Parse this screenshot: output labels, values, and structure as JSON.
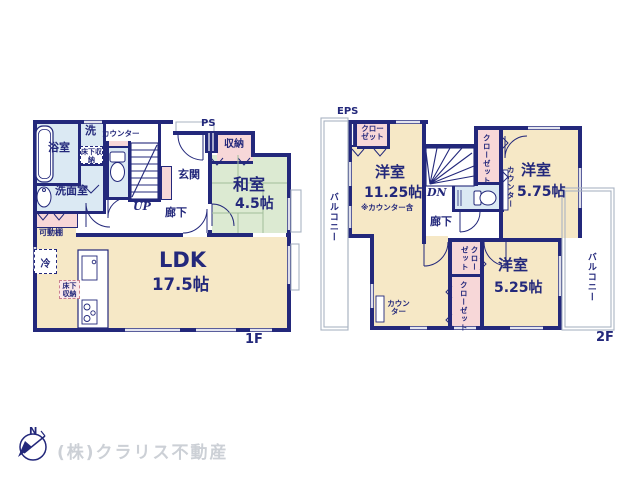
{
  "colors": {
    "wall_navy": "#23287b",
    "room_cream": "#f6e8c6",
    "tatami_green": "#dcead2",
    "wet_blue": "#dbe9f3",
    "closet_pink": "#f7d7d8",
    "outline_gray": "#a9b3c2",
    "company_gray": "#ccd0d6"
  },
  "floor1": {
    "floor_label": "1F",
    "bath": "浴室",
    "laundry": "洗",
    "underfloor_laundry": "床下収納",
    "washroom": "洗面室",
    "counter": "カウンター",
    "movable_shelf": "可動棚",
    "ps": "PS",
    "storage": "収納",
    "entrance": "玄関",
    "up": "UP",
    "hallway": "廊下",
    "washitsu_name": "和室",
    "washitsu_size": "4.5帖",
    "fridge": "冷",
    "underfloor_kitchen": "床下収納",
    "ldk_name": "LDK",
    "ldk_size": "17.5帖"
  },
  "floor2": {
    "floor_label": "2F",
    "eps": "EPS",
    "closet_topleft": "クローゼット",
    "bedroom1_name": "洋室",
    "bedroom1_size": "11.25帖",
    "bedroom1_note": "※カウンター含",
    "dn": "DN",
    "hallway": "廊下",
    "closet_mid": "クローゼット",
    "counter_mid": "カウンター",
    "bedroom2_name": "洋室",
    "bedroom2_size": "5.75帖",
    "closet_upper": "クローゼット",
    "closet_lower": "クローゼット",
    "bedroom3_name": "洋室",
    "bedroom3_size": "5.25帖",
    "counter_desk": "カウンター",
    "balcony_left": "バルコニー",
    "balcony_right": "バルコニー"
  },
  "footer": {
    "company": "(株)クラリス不動産",
    "compass_north": "N"
  }
}
